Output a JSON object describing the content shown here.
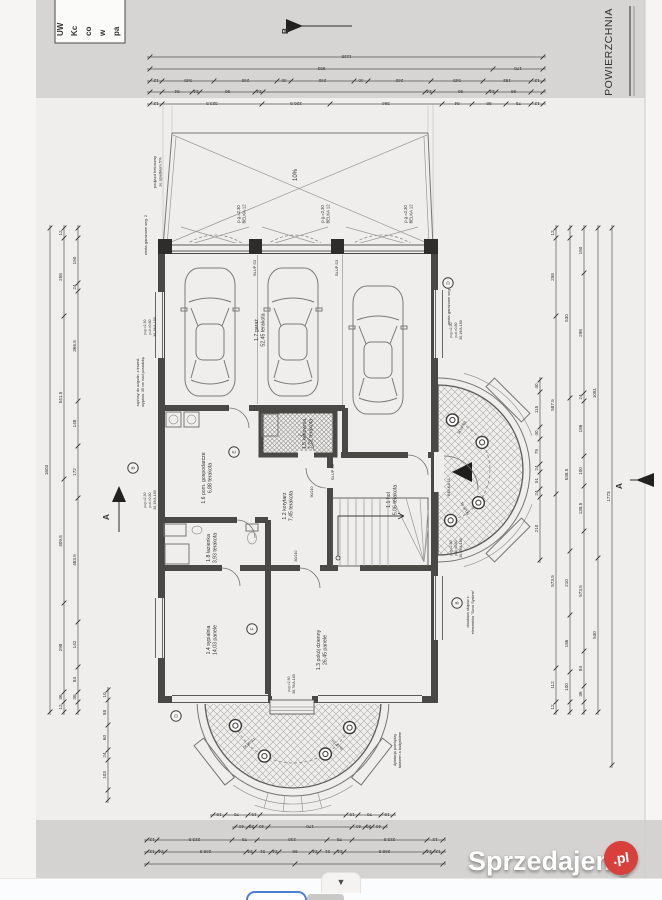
{
  "source_overlay": {
    "watermark_brand": "Sprzedajemy",
    "watermark_tld": ".pl",
    "badge_color": "#d8403c"
  },
  "viewer": {
    "collapse_arrow": "▼"
  },
  "scan": {
    "corner_note_lines": [
      "UW",
      "Kc",
      "co",
      "w",
      "pa"
    ],
    "area_header": "POWIERZCHNIA",
    "rooms": [
      {
        "id": "1.7",
        "name": "garaż",
        "area": "52,45",
        "finish": "terakota",
        "x": 258,
        "y": 330
      },
      {
        "id": "1.6",
        "name": "pom. gospodarcze",
        "area": "6,88",
        "finish": "terakota",
        "x": 205,
        "y": 478
      },
      {
        "id": "1.5",
        "name": "kotłownia",
        "area": "7,72",
        "finish": "terakota",
        "x": 306,
        "y": 434
      },
      {
        "id": "1.2",
        "name": "korytarz",
        "area": "7,45",
        "finish": "terakota",
        "x": 286,
        "y": 506
      },
      {
        "id": "1.1",
        "name": "hol",
        "area": "5,06",
        "finish": "terakota",
        "x": 390,
        "y": 500
      },
      {
        "id": "1.8",
        "name": "łazienka",
        "area": "3,93",
        "finish": "terakota",
        "x": 210,
        "y": 548
      },
      {
        "id": "1.4",
        "name": "sypialnia",
        "area": "14,03",
        "finish": "panele",
        "x": 210,
        "y": 640
      },
      {
        "id": "1.3",
        "name": "pokój dzienny",
        "area": "26,45",
        "finish": "panele",
        "x": 320,
        "y": 650
      }
    ],
    "annotations": [
      {
        "lines": [
          "podjazd betonowy",
          "ze spadkiem 5%"
        ],
        "x": 156,
        "y": 172,
        "s": 4
      },
      {
        "lines": [
          "10%"
        ],
        "x": 297,
        "y": 175,
        "s": 6
      },
      {
        "lines": [
          "wrota garażowe seg. 2"
        ],
        "x": 147,
        "y": 235,
        "s": 4
      },
      {
        "lines": [
          "wrota garażowe seg. 2"
        ],
        "x": 450,
        "y": 305,
        "s": 4
      },
      {
        "lines": [
          "p.g.=2,30",
          "BELKA 12"
        ],
        "x": 240,
        "y": 214,
        "s": 4.2
      },
      {
        "lines": [
          "p.g.=2,30",
          "BELKA 12"
        ],
        "x": 324,
        "y": 214,
        "s": 4.2
      },
      {
        "lines": [
          "p.g.=2,30",
          "BELKA 12"
        ],
        "x": 407,
        "y": 214,
        "s": 4.2
      },
      {
        "lines": [
          "SŁUP S3"
        ],
        "x": 256,
        "y": 268,
        "s": 4
      },
      {
        "lines": [
          "SŁUP S3"
        ],
        "x": 338,
        "y": 268,
        "s": 4
      },
      {
        "lines": [
          "SŁUP S2"
        ],
        "x": 334,
        "y": 472,
        "s": 4
      },
      {
        "lines": [
          "BELKA 11"
        ],
        "x": 450,
        "y": 487,
        "s": 4
      },
      {
        "lines": [
          "szprosy do uzgodn. z inwest.",
          "wyprow. 35 cm nad posadzkę"
        ],
        "x": 139,
        "y": 382,
        "s": 3.8
      },
      {
        "lines": [
          "p.g.=2,30",
          "p.d.=0,80",
          "36,19/A-180"
        ],
        "x": 146,
        "y": 327,
        "s": 3.6
      },
      {
        "lines": [
          "p.g.=2,30",
          "p.d.=0,80",
          "36,19/A-180"
        ],
        "x": 146,
        "y": 500,
        "s": 3.6
      },
      {
        "lines": [
          "p.g.=2,30",
          "p.d.=0,80",
          "36,19/A-180"
        ],
        "x": 452,
        "y": 330,
        "s": 3.6
      },
      {
        "lines": [
          "p.g.=2,30",
          "p.d.=0,80",
          "36,19/A-180"
        ],
        "x": 452,
        "y": 548,
        "s": 3.6
      },
      {
        "lines": [
          "p.g.=2,30",
          "36,76/A-180"
        ],
        "x": 290,
        "y": 684,
        "s": 3.6
      },
      {
        "lines": [
          "obudowa słupów z",
          "elementów \"Sova System\""
        ],
        "x": 469,
        "y": 612,
        "s": 3.8
      },
      {
        "lines": [
          "dylatacja pomiędzy",
          "tarasem a budynkiem"
        ],
        "x": 396,
        "y": 750,
        "s": 3.8
      },
      {
        "lines": [
          "90/210"
        ],
        "x": 313,
        "y": 492,
        "s": 3.6
      },
      {
        "lines": [
          "80/210"
        ],
        "x": 297,
        "y": 556,
        "s": 3.6
      },
      {
        "lines": [
          "SŁUP S1"
        ],
        "x": 463,
        "y": 428,
        "s": 3.6,
        "r": -60
      },
      {
        "lines": [
          "SŁUP S1"
        ],
        "x": 466,
        "y": 508,
        "s": 3.6,
        "r": -120
      },
      {
        "lines": [
          "SŁUP S1"
        ],
        "x": 338,
        "y": 744,
        "s": 3.6,
        "r": -140
      },
      {
        "lines": [
          "SŁUP S1"
        ],
        "x": 250,
        "y": 744,
        "s": 3.6,
        "r": -40
      }
    ],
    "bubbles": [
      {
        "t": "D",
        "x": 448,
        "y": 283
      },
      {
        "t": "E",
        "x": 234,
        "y": 452
      },
      {
        "t": "F",
        "x": 252,
        "y": 629
      },
      {
        "t": "D",
        "x": 176,
        "y": 716
      },
      {
        "t": "B",
        "x": 133,
        "y": 468
      },
      {
        "t": "B",
        "x": 457,
        "y": 603
      }
    ],
    "markers": [
      {
        "t": "B",
        "x": 288,
        "y": 31,
        "line": [
          300,
          26,
          352,
          26
        ],
        "tri": "286,19 286,33 303,26"
      },
      {
        "t": "A",
        "x": 622,
        "y": 486,
        "line": [
          630,
          480,
          654,
          480
        ],
        "tri": "654,473 654,487 636,480"
      },
      {
        "t": "A",
        "x": 109,
        "y": 517,
        "line": [
          119,
          494,
          119,
          532
        ],
        "tri": "112,502 126,502 119,486"
      }
    ],
    "chains": [
      {
        "o": "h",
        "at": 57,
        "from": 150,
        "segs": [
          [
            393,
            "1125"
          ]
        ]
      },
      {
        "o": "h",
        "at": 69,
        "from": 150,
        "segs": [
          [
            343,
            "953"
          ],
          [
            50,
            "170"
          ]
        ]
      },
      {
        "o": "h",
        "at": 81,
        "from": 150,
        "segs": [
          [
            12,
            "12"
          ],
          [
            52,
            "545"
          ],
          [
            63,
            "240"
          ],
          [
            14,
            "40"
          ],
          [
            63,
            "240"
          ],
          [
            14,
            "40"
          ],
          [
            63,
            "240"
          ],
          [
            52,
            "545"
          ],
          [
            48,
            "192"
          ],
          [
            12,
            "12"
          ]
        ]
      },
      {
        "o": "h",
        "at": 92,
        "from": 150,
        "segs": [
          [
            12,
            ""
          ],
          [
            30,
            "84"
          ],
          [
            8,
            "24"
          ],
          [
            55,
            "90"
          ],
          [
            8,
            "24"
          ],
          [
            162,
            ""
          ],
          [
            8,
            "24"
          ],
          [
            55,
            "90"
          ],
          [
            8,
            "24"
          ],
          [
            35,
            "98"
          ],
          [
            12,
            ""
          ]
        ]
      },
      {
        "o": "h",
        "at": 104,
        "from": 150,
        "segs": [
          [
            12,
            "12"
          ],
          [
            100,
            "323.5"
          ],
          [
            68,
            "220.5"
          ],
          [
            112,
            "364"
          ],
          [
            30,
            "84"
          ],
          [
            34,
            "98"
          ],
          [
            25,
            "75"
          ],
          [
            12,
            "12"
          ]
        ]
      },
      {
        "o": "h",
        "at": 815,
        "from": 213,
        "segs": [
          [
            12,
            "19"
          ],
          [
            23,
            "70"
          ],
          [
            12,
            "19"
          ],
          [
            86,
            ""
          ],
          [
            12,
            "19"
          ],
          [
            23,
            "70"
          ],
          [
            12,
            "19"
          ]
        ]
      },
      {
        "o": "h",
        "at": 827,
        "from": 235,
        "segs": [
          [
            13,
            "40"
          ],
          [
            7,
            "20"
          ],
          [
            13,
            "40"
          ],
          [
            84,
            "170"
          ],
          [
            13,
            "40"
          ],
          [
            7,
            "20"
          ],
          [
            13,
            "40"
          ]
        ]
      },
      {
        "o": "h",
        "at": 840,
        "from": 147,
        "segs": [
          [
            10,
            "12"
          ],
          [
            75,
            "223.5"
          ],
          [
            25,
            "75"
          ],
          [
            70,
            "210"
          ],
          [
            25,
            "75"
          ],
          [
            75,
            "223.5"
          ],
          [
            16,
            "12"
          ]
        ]
      },
      {
        "o": "h",
        "at": 852,
        "from": 147,
        "segs": [
          [
            10,
            "12"
          ],
          [
            8,
            "24"
          ],
          [
            81,
            "248.5"
          ],
          [
            8,
            "24"
          ],
          [
            17,
            "51"
          ],
          [
            8,
            "24"
          ],
          [
            32,
            "96"
          ],
          [
            8,
            "24"
          ],
          [
            17,
            "51"
          ],
          [
            8,
            "24"
          ],
          [
            81,
            "248.5"
          ],
          [
            8,
            "24"
          ],
          [
            10,
            "12"
          ]
        ]
      },
      {
        "o": "h",
        "at": 864,
        "from": 147,
        "segs": [
          [
            148,
            ""
          ],
          [
            148,
            ""
          ]
        ]
      },
      {
        "o": "v",
        "at": 50,
        "from": 228,
        "segs": [
          [
            484,
            "1603"
          ]
        ]
      },
      {
        "o": "v",
        "at": 64,
        "from": 228,
        "segs": [
          [
            10,
            "12"
          ],
          [
            78,
            "258"
          ],
          [
            163,
            "541.5"
          ],
          [
            124,
            "409.5"
          ],
          [
            89,
            "298"
          ],
          [
            10,
            "36"
          ],
          [
            10,
            "12"
          ]
        ]
      },
      {
        "o": "v",
        "at": 78,
        "from": 228,
        "segs": [
          [
            10,
            ""
          ],
          [
            45,
            "150"
          ],
          [
            8,
            "24"
          ],
          [
            110,
            "366.5"
          ],
          [
            45,
            "148"
          ],
          [
            52,
            "172"
          ],
          [
            124,
            "483.5"
          ],
          [
            45,
            "142"
          ],
          [
            25,
            "84"
          ],
          [
            10,
            "36"
          ],
          [
            10,
            ""
          ]
        ]
      },
      {
        "o": "v",
        "at": 108,
        "from": 690,
        "segs": [
          [
            10,
            "10"
          ],
          [
            25,
            "58"
          ],
          [
            25,
            "60"
          ],
          [
            10,
            "24"
          ],
          [
            30,
            "103"
          ],
          [
            10,
            ""
          ]
        ]
      },
      {
        "o": "v",
        "at": 556,
        "from": 228,
        "segs": [
          [
            10,
            "12"
          ],
          [
            78,
            "258"
          ],
          [
            178,
            "587.5"
          ],
          [
            174,
            "573.5"
          ],
          [
            34,
            "112"
          ],
          [
            10,
            "12"
          ]
        ]
      },
      {
        "o": "v",
        "at": 570,
        "from": 228,
        "segs": [
          [
            10,
            ""
          ],
          [
            160,
            "530"
          ],
          [
            153,
            "538.5"
          ],
          [
            64,
            "210"
          ],
          [
            57,
            "186"
          ],
          [
            30,
            "100"
          ],
          [
            10,
            ""
          ]
        ]
      },
      {
        "o": "v",
        "at": 584,
        "from": 228,
        "segs": [
          [
            45,
            "150"
          ],
          [
            120,
            "298"
          ],
          [
            8,
            "24"
          ],
          [
            55,
            "186"
          ],
          [
            30,
            "100"
          ],
          [
            45,
            "138.5"
          ],
          [
            120,
            "573.5"
          ],
          [
            35,
            "84"
          ],
          [
            16,
            "36"
          ],
          [
            10,
            ""
          ]
        ]
      },
      {
        "o": "v",
        "at": 598,
        "from": 228,
        "segs": [
          [
            330,
            "1081"
          ],
          [
            154,
            "530"
          ]
        ]
      },
      {
        "o": "v",
        "at": 612,
        "from": 228,
        "segs": [
          [
            537,
            "1773"
          ]
        ]
      },
      {
        "o": "v",
        "at": 540,
        "from": 380,
        "segs": [
          [
            12,
            "40"
          ],
          [
            35,
            "115"
          ],
          [
            12,
            "40"
          ],
          [
            25,
            "75"
          ],
          [
            8,
            "24"
          ],
          [
            17,
            "51"
          ],
          [
            8,
            "24"
          ],
          [
            63,
            "210"
          ]
        ]
      }
    ]
  }
}
